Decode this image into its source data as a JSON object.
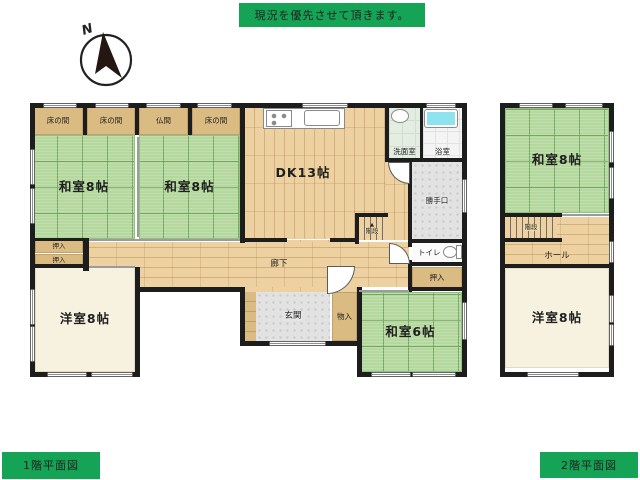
{
  "banner": {
    "text": "現況を優先させて頂きます。"
  },
  "compass": {
    "label": "N"
  },
  "floor1": {
    "caption": "1階平面図",
    "rooms": {
      "tokonoma1": "床の間",
      "tokonoma2": "床の間",
      "butsuma": "仏間",
      "tokonoma3": "床の間",
      "washitsu_a": "和室8帖",
      "washitsu_b": "和室8帖",
      "dk": "DK13帖",
      "senmen": "洗面室",
      "yokushitsu": "浴室",
      "katteguchi": "勝手口",
      "kaidan": "階段",
      "toilet": "トイレ",
      "oshiire_right": "押入",
      "oshiire_left_1": "押入",
      "oshiire_left_2": "押入",
      "rouka": "廊下",
      "yoshitsu": "洋室8帖",
      "genkan": "玄関",
      "monoire": "物入",
      "washitsu_c": "和室6帖"
    },
    "icons": {
      "stairs_up_arrow": "▲"
    }
  },
  "floor2": {
    "caption": "2階平面図",
    "rooms": {
      "washitsu": "和室8帖",
      "kaidan": "階段",
      "hall": "ホール",
      "yoshitsu": "洋室8帖"
    }
  },
  "colors": {
    "accent": "#15a356",
    "tatami": "#b5d89e",
    "wood": "#edd1a1",
    "tan": "#dabb82",
    "tile": "#e2e2e2",
    "cream": "#f7f2df",
    "tub": "#8fe3ee",
    "wall": "#1d1d1d"
  }
}
